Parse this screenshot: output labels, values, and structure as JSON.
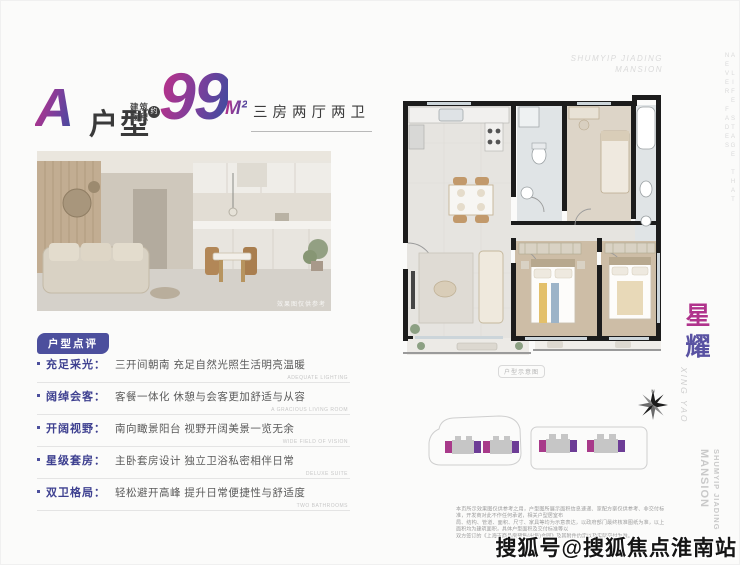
{
  "header": {
    "plan_letter": "A",
    "plan_word": "户型",
    "area_prefix_line1": "建筑",
    "area_prefix_line2": "面积",
    "area_approx": "约",
    "area_value": "99",
    "area_unit": "M²",
    "layout_tag": "三房两厅两卫"
  },
  "photo": {
    "caption": "效果图仅供参考"
  },
  "review": {
    "badge": "户型点评",
    "items": [
      {
        "label": "充足采光",
        "desc": "三开间朝南 充足自然光照生活明亮温暖",
        "en": "ADEQUATE LIGHTING"
      },
      {
        "label": "阔绰会客",
        "desc": "客餐一体化 休憩与会客更加舒适与从容",
        "en": "A GRACIOUS LIVING ROOM"
      },
      {
        "label": "开阔视野",
        "desc": "南向瞰景阳台 视野开阔美景一览无余",
        "en": "WIDE FIELD OF VISION"
      },
      {
        "label": "星级套房",
        "desc": "主卧套房设计 独立卫浴私密相伴日常",
        "en": "DELUXE SUITE"
      },
      {
        "label": "双卫格局",
        "desc": "轻松避开高峰 提升日常便捷性与舒适度",
        "en": "TWO BATHROOMS"
      }
    ]
  },
  "floorplan": {
    "caption": "户型示意图",
    "compass_label": "N"
  },
  "brand": {
    "top_line1": "SHUMYIP JIADING",
    "top_line2": "MANSION",
    "side_name_char1": "星",
    "side_name_char2": "耀",
    "side_name_en": "XING YAO",
    "edge_slogan": "A LIFE STAGE THAT NEVER FADES",
    "bottom_vertical_big": "MANSION",
    "bottom_vertical_small": "SHUMYIP JIADING"
  },
  "disclaimer": {
    "line1": "本页所示效果图仅供参考之用，户型图所展示面积信息速递、家配方案仅供参考、非交付标准，开发商对此不作任何承诺，相关户型居室布",
    "line2": "局、结构、管道、面积、尺寸、家具等均为示意表达，以政府部门最终核准图纸为准，以上面积均为建筑面积，具体户型面积及交付标准等以",
    "line3": "双方签订的《上海市商品房预售(出售)合同》及其附件约定以及实际交付为准。"
  },
  "watermark": {
    "text": "搜狐号@搜狐焦点淮南站"
  },
  "colors": {
    "accent_magenta": "#b0338c",
    "accent_purple": "#5952a2",
    "badge_purple": "#4c4f9d",
    "wall_black": "#1c1c1c"
  }
}
